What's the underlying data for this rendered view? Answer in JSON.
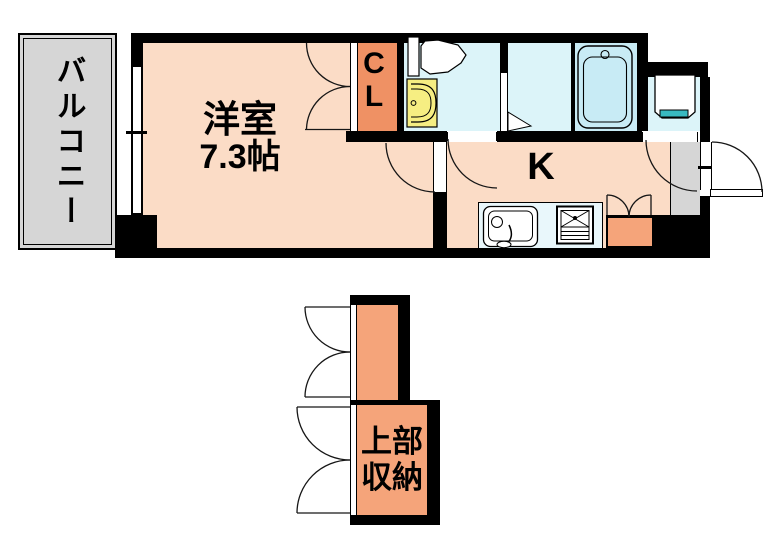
{
  "plan": {
    "rooms": {
      "balcony": {
        "label": "バルコニー"
      },
      "western": {
        "label": "洋室",
        "area": "7.3帖"
      },
      "closet": {
        "l1": "C",
        "l2": "L"
      },
      "kitchen": {
        "label": "K"
      },
      "upper_storage": {
        "l1": "上部",
        "l2": "収納"
      }
    },
    "colors": {
      "wall": "#000000",
      "line": "#161616",
      "floor": "#FBDCC6",
      "closet": "#EF9164",
      "storage": "#F5A47A",
      "sanitary": "#DCF4F9",
      "bath": "#C8EBF5",
      "counter": "#E9F7FB",
      "gray": "#D6D6D6",
      "teal": "#38B9C0",
      "basin": "#F6EE82"
    }
  }
}
